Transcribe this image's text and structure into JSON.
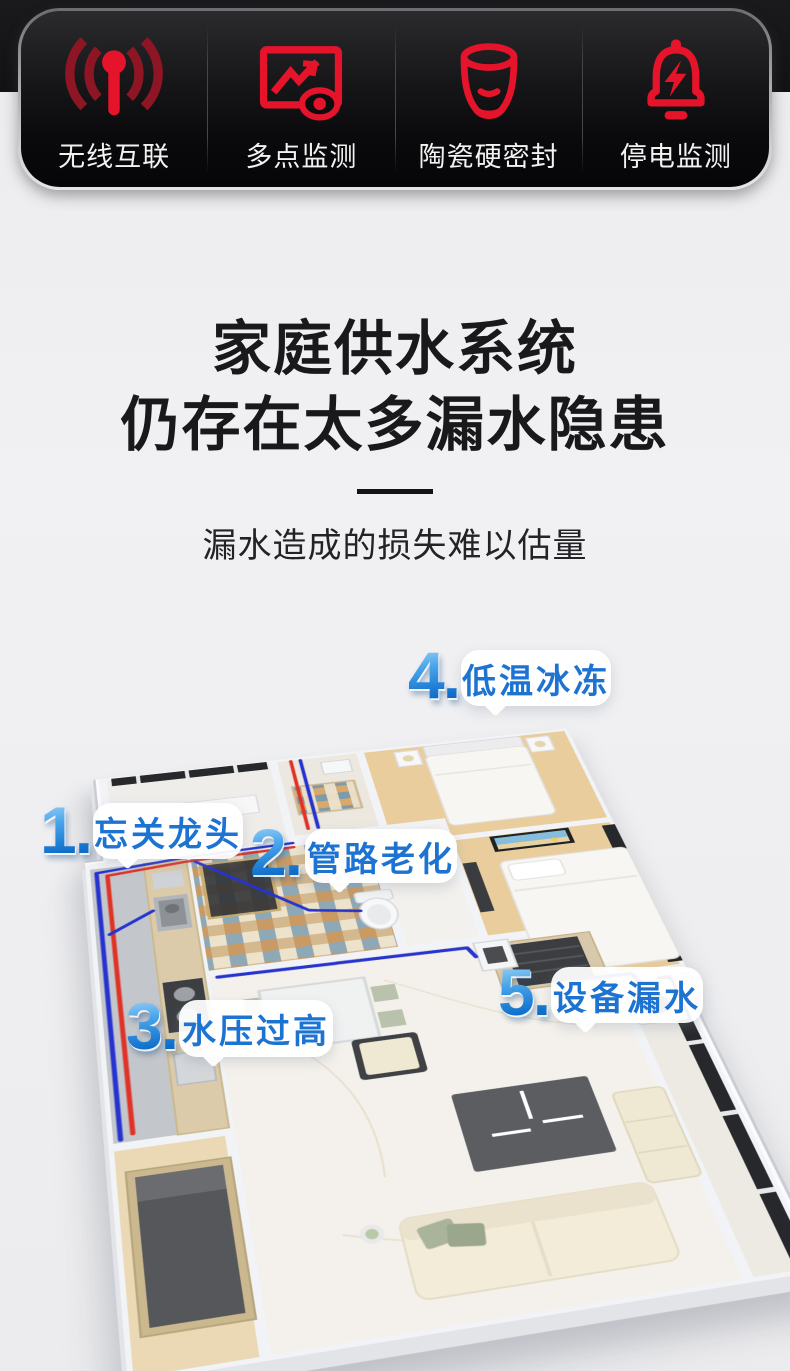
{
  "feature_bar": {
    "icon_color": "#e5142b",
    "icon_dark_red": "#8e1624",
    "label_color": "#f2f2f2",
    "items": [
      {
        "label": "无线互联",
        "icon": "wireless-signal-icon"
      },
      {
        "label": "多点监测",
        "icon": "screen-monitor-icon"
      },
      {
        "label": "陶瓷硬密封",
        "icon": "ceramic-valve-icon"
      },
      {
        "label": "停电监测",
        "icon": "power-outage-alarm-icon"
      }
    ]
  },
  "headline": {
    "line1": "家庭供水系统",
    "line2": "仍存在太多漏水隐患",
    "subtitle": "漏水造成的损失难以估量"
  },
  "floor_plan": {
    "number_color": "#2e8fe0",
    "label_color": "#1d73d2",
    "pipe_blue": "#2633cf",
    "pipe_red": "#e03226",
    "callouts": [
      {
        "num": "1.",
        "label": "忘关龙头"
      },
      {
        "num": "2.",
        "label": "管路老化"
      },
      {
        "num": "3.",
        "label": "水压过高"
      },
      {
        "num": "4.",
        "label": "低温冰冻"
      },
      {
        "num": "5.",
        "label": "设备漏水"
      }
    ]
  }
}
